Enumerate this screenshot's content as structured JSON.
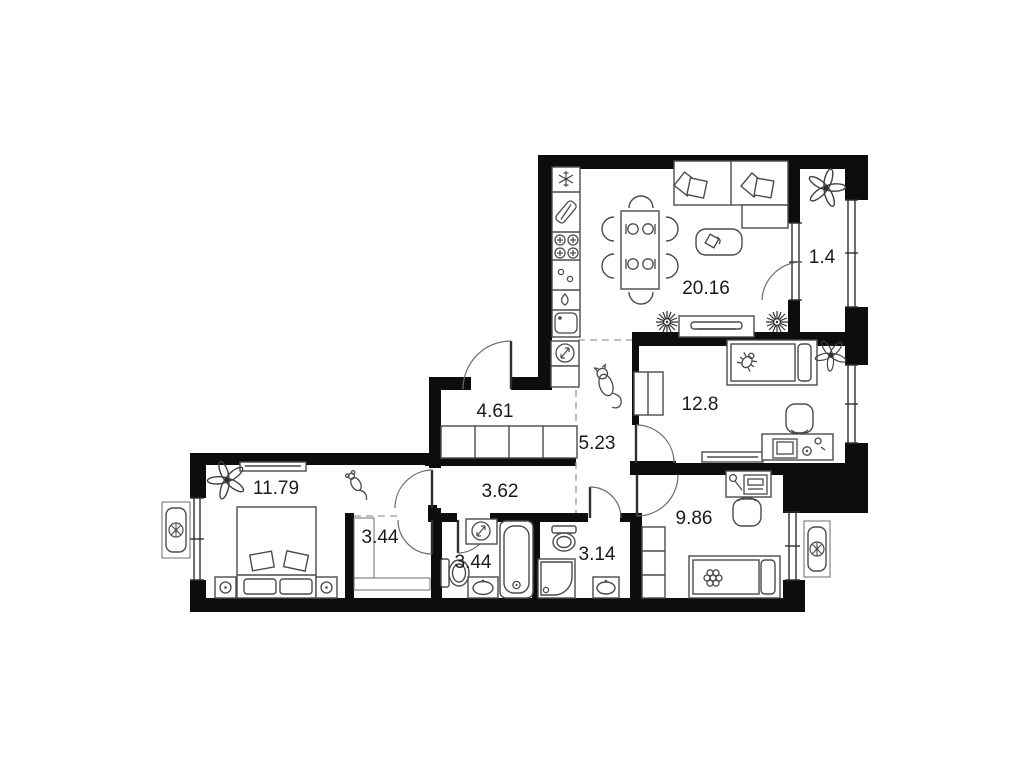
{
  "plan": {
    "background": "#ffffff",
    "wall_color": "#0d0d0d",
    "furniture_color": "#4b4b4b",
    "label_color": "#1a1a1a",
    "dash_color": "#9a9a9a",
    "rooms": [
      {
        "id": "kitchen-living",
        "area": "20.16"
      },
      {
        "id": "balcony",
        "area": "1.4"
      },
      {
        "id": "bedroom-right",
        "area": "12.8"
      },
      {
        "id": "storage-room",
        "area": "4.61"
      },
      {
        "id": "hallway",
        "area": "5.23"
      },
      {
        "id": "corridor",
        "area": "3.62"
      },
      {
        "id": "bedroom-left",
        "area": "11.79"
      },
      {
        "id": "closet",
        "area": "3.44"
      },
      {
        "id": "bathroom",
        "area": "3.44"
      },
      {
        "id": "wc",
        "area": "3.14"
      },
      {
        "id": "bedroom-bottom",
        "area": "9.86"
      }
    ],
    "icons": {
      "fridge": "snowflake",
      "cutting-board": "board-with-knife",
      "stove": "four-burners",
      "radiator": "star-burst",
      "plant": "flower",
      "ac-unit": "fan-in-box",
      "electric-panel": "circle-lightning",
      "water-heater": "circle-lightning",
      "cat": "cat-silhouette",
      "mouse": "mouse-silhouette"
    }
  }
}
